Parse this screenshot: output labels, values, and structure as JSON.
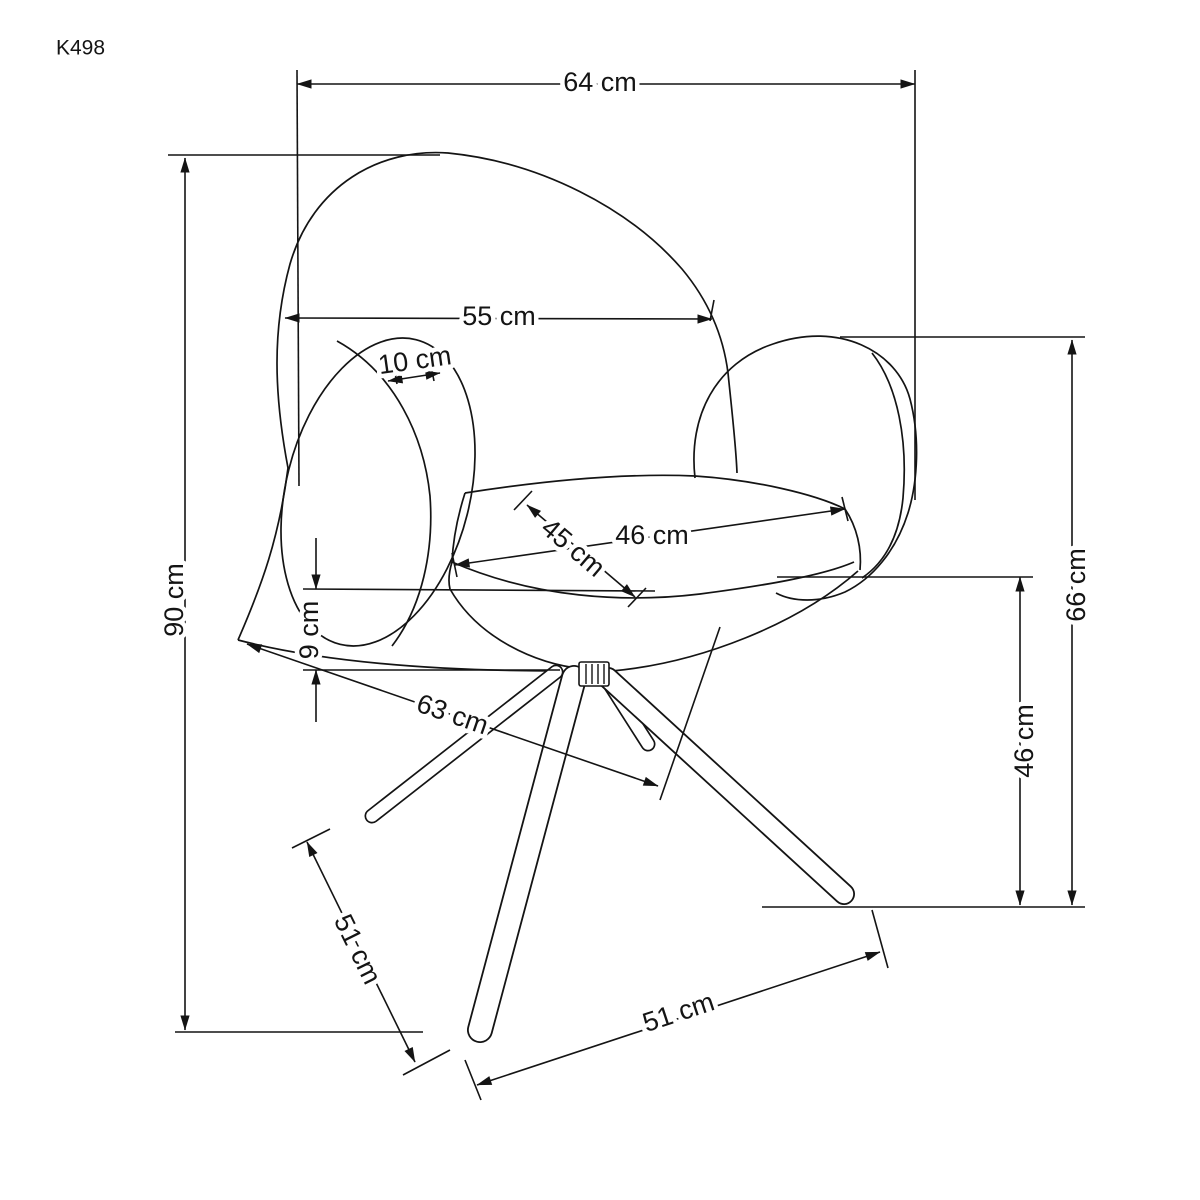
{
  "drawing": {
    "model": "K498",
    "dimensions": {
      "overall_width": "64 cm",
      "backrest_width": "55 cm",
      "shell_thickness": "10 cm",
      "overall_height": "90 cm",
      "seat_depth": "45 cm",
      "seat_width": "46 cm",
      "seat_edge_thickness": "9 cm",
      "base_depth": "63 cm",
      "armrest_height": "66 cm",
      "seat_height": "46 cm",
      "leg_length_side": "51 cm",
      "leg_length_front": "51 cm"
    }
  }
}
